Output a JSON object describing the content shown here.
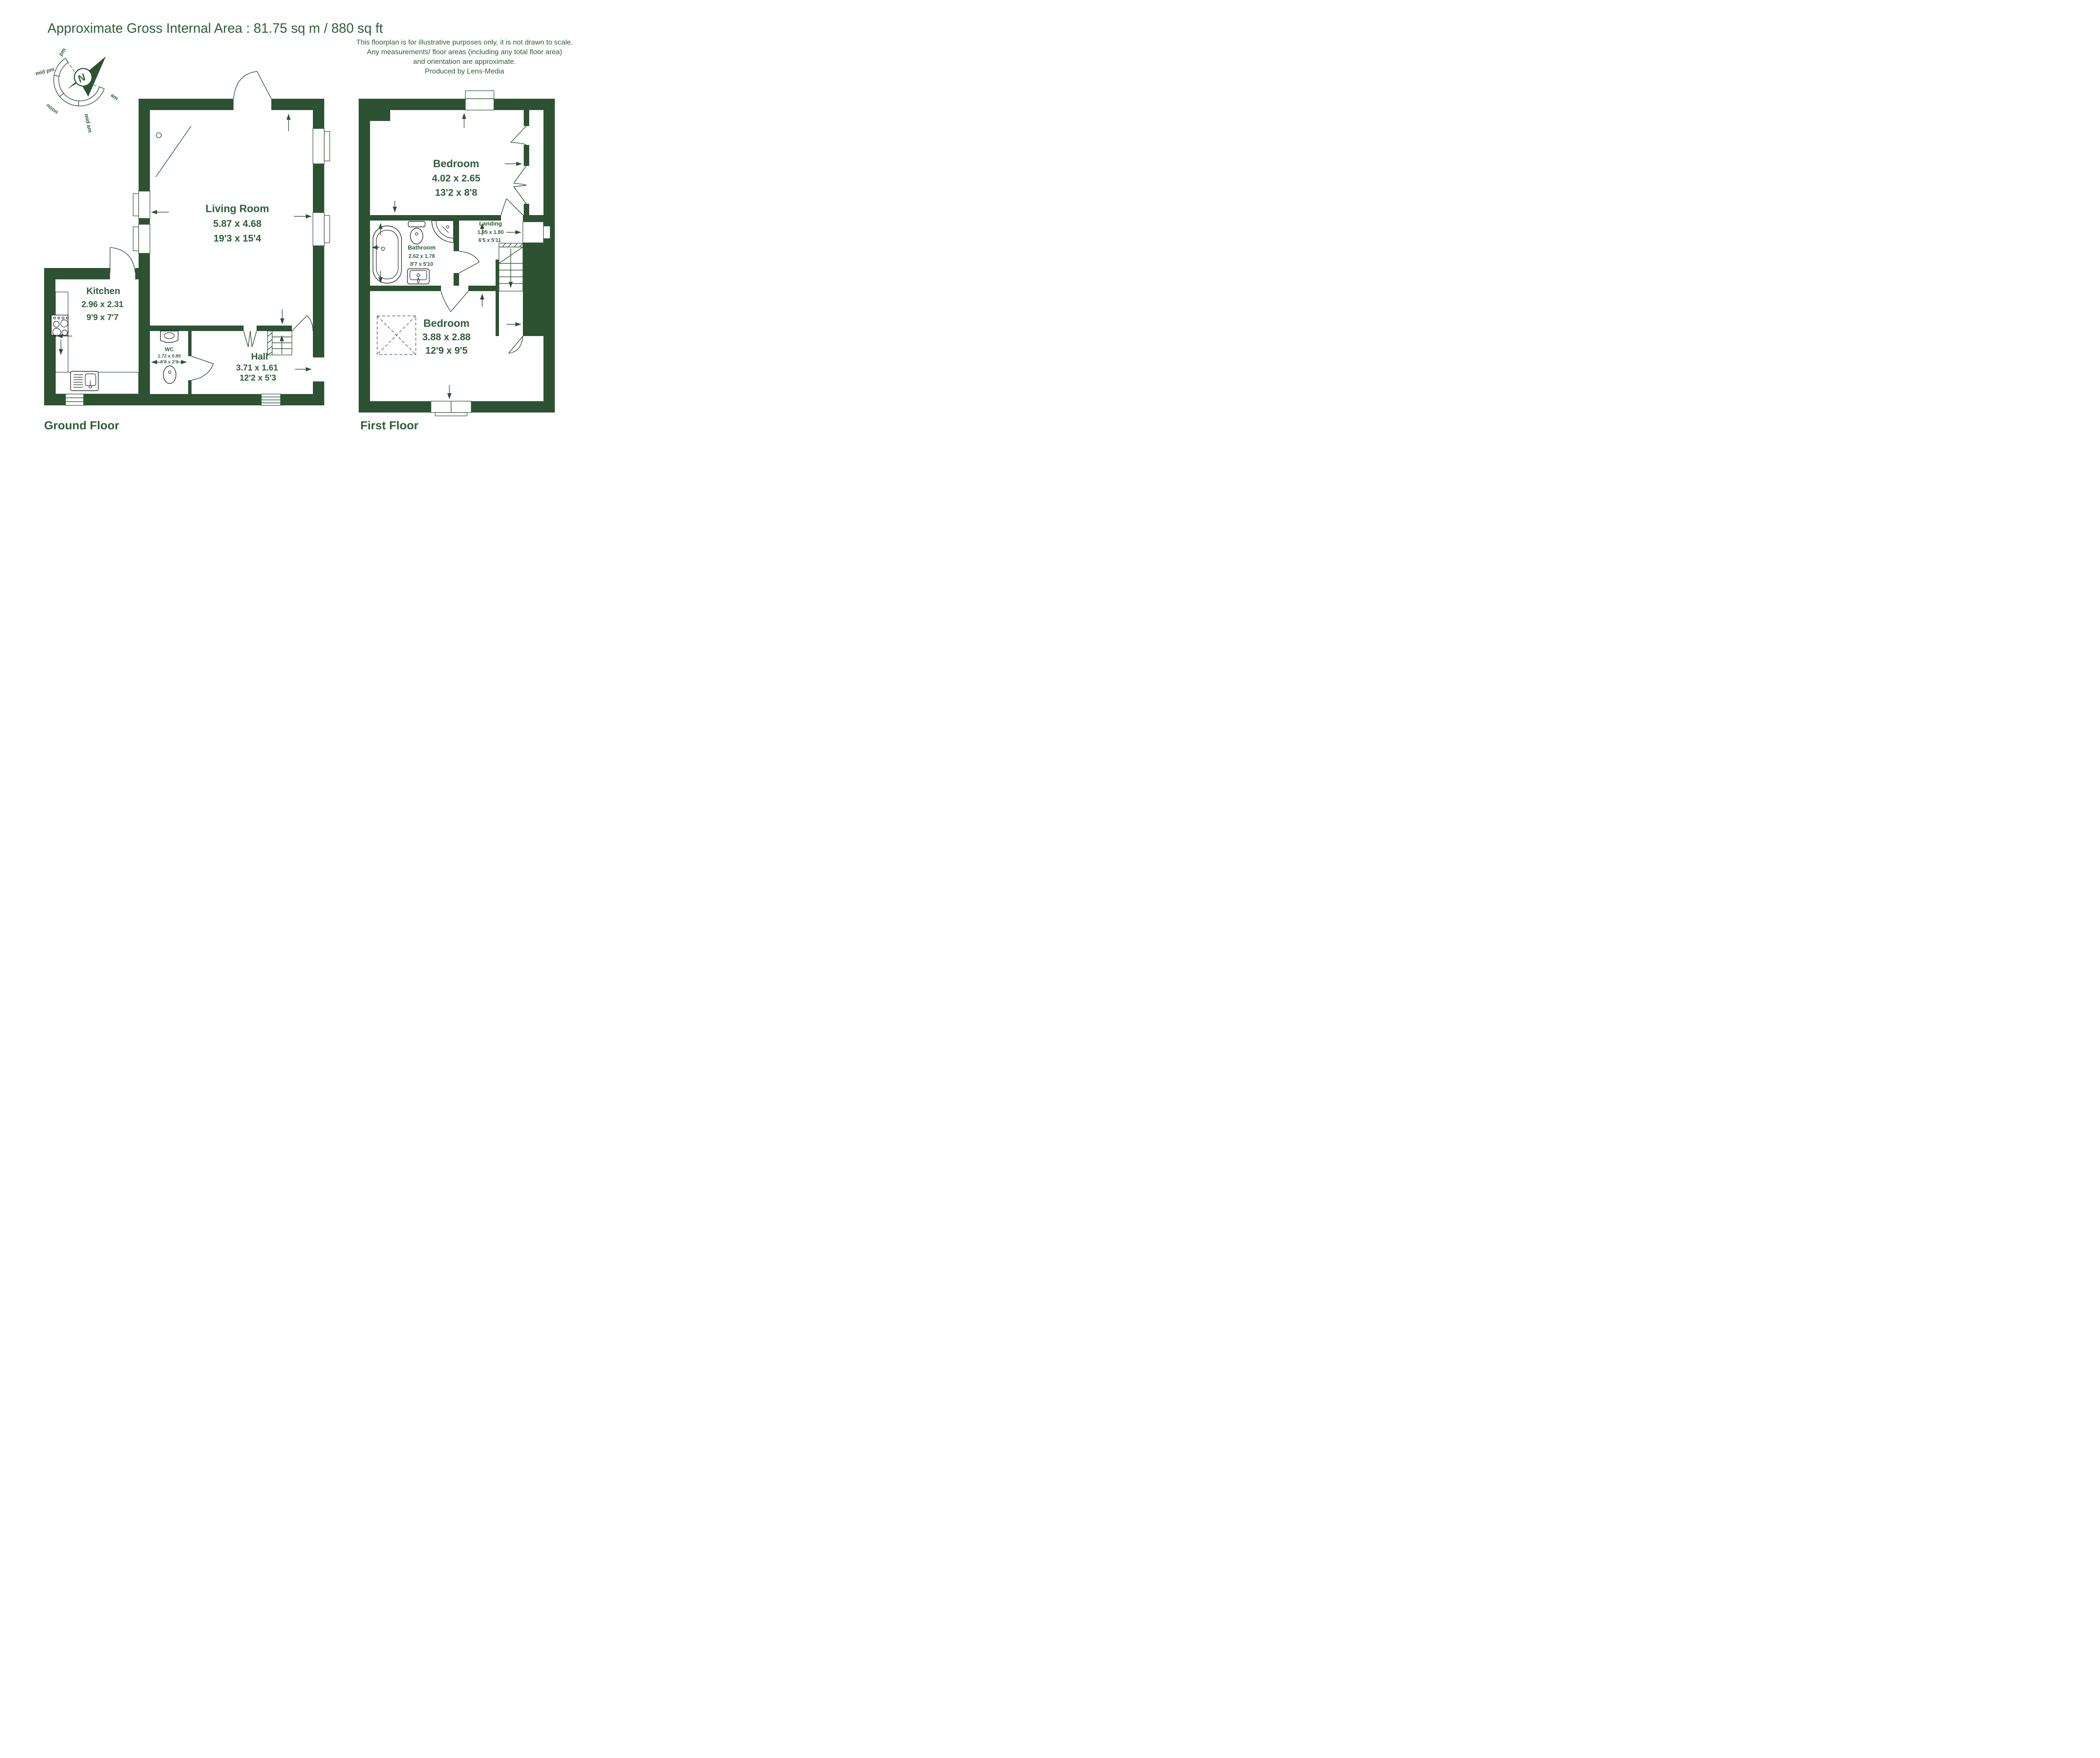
{
  "title": "Approximate Gross Internal Area : 81.75 sq m / 880 sq ft",
  "disclaimer": {
    "line1": "This floorplan is for illustrative purposes only, it is not drawn to scale.",
    "line2": "Any measurements/ floor areas (including any total floor area)",
    "line3": "and orientation are approximate.",
    "line4": "Produced by Lens-Media"
  },
  "compass": {
    "north": "N",
    "labels": {
      "pm": "pm",
      "mid_pm": "mid pm",
      "noon": "noon",
      "mid_am": "mid am",
      "am": "am"
    }
  },
  "colors": {
    "wall_green": "#2d5232",
    "text_green": "#2d5f38",
    "fixture_line": "#1a1a1a",
    "background": "#ffffff"
  },
  "ground_floor": {
    "label": "Ground Floor",
    "rooms": {
      "living_room": {
        "name": "Living Room",
        "metric": "5.87 x 4.68",
        "imperial": "19'3 x 15'4"
      },
      "kitchen": {
        "name": "Kitchen",
        "metric": "2.96 x 2.31",
        "imperial": "9'9 x 7'7"
      },
      "wc": {
        "name": "WC",
        "metric": "1.72 x 0.85",
        "imperial": "5'8 x 2'9"
      },
      "hall": {
        "name": "Hall",
        "metric": "3.71 x 1.61",
        "imperial": "12'2 x 5'3"
      }
    }
  },
  "first_floor": {
    "label": "First Floor",
    "rooms": {
      "bedroom_1": {
        "name": "Bedroom",
        "metric": "4.02 x 2.65",
        "imperial": "13'2 x 8'8"
      },
      "landing": {
        "name": "Landing",
        "metric": "1.95 x 1.80",
        "imperial": "6'5 x 5'11"
      },
      "bathroom": {
        "name": "Bathroom",
        "metric": "2.62 x 1.78",
        "imperial": "8'7 x 5'10"
      },
      "bedroom_2": {
        "name": "Bedroom",
        "metric": "3.88 x 2.88",
        "imperial": "12'9 x 9'5"
      }
    }
  }
}
